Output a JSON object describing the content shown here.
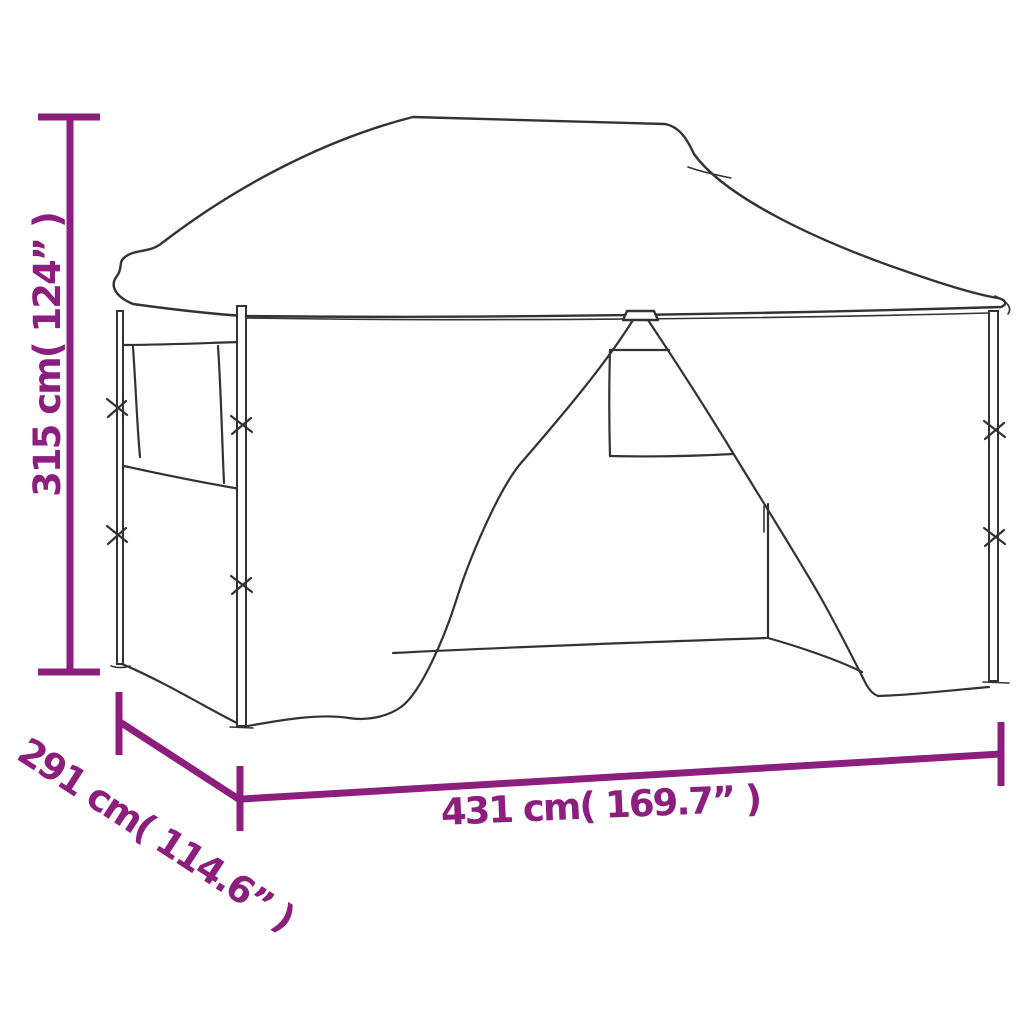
{
  "page": {
    "kind": "product-dimension-diagram",
    "subject": "pop-up gazebo tent with sidewalls, line drawing front view"
  },
  "colors": {
    "dimension": "#8C1E7E",
    "line": "#333333",
    "background": "#ffffff"
  },
  "dimensions": {
    "height": {
      "label": "315 cm( 124” )",
      "value_cm": "315",
      "value_inch": "124",
      "orientation": "vertical-left"
    },
    "depth": {
      "label": "291 cm( 114.6” )",
      "value_cm": "291",
      "value_inch": "114.6",
      "orientation": "diagonal-bottom-left"
    },
    "width": {
      "label": "431 cm( 169.7” )",
      "value_cm": "431",
      "value_inch": "169.7",
      "orientation": "horizontal-bottom"
    }
  }
}
